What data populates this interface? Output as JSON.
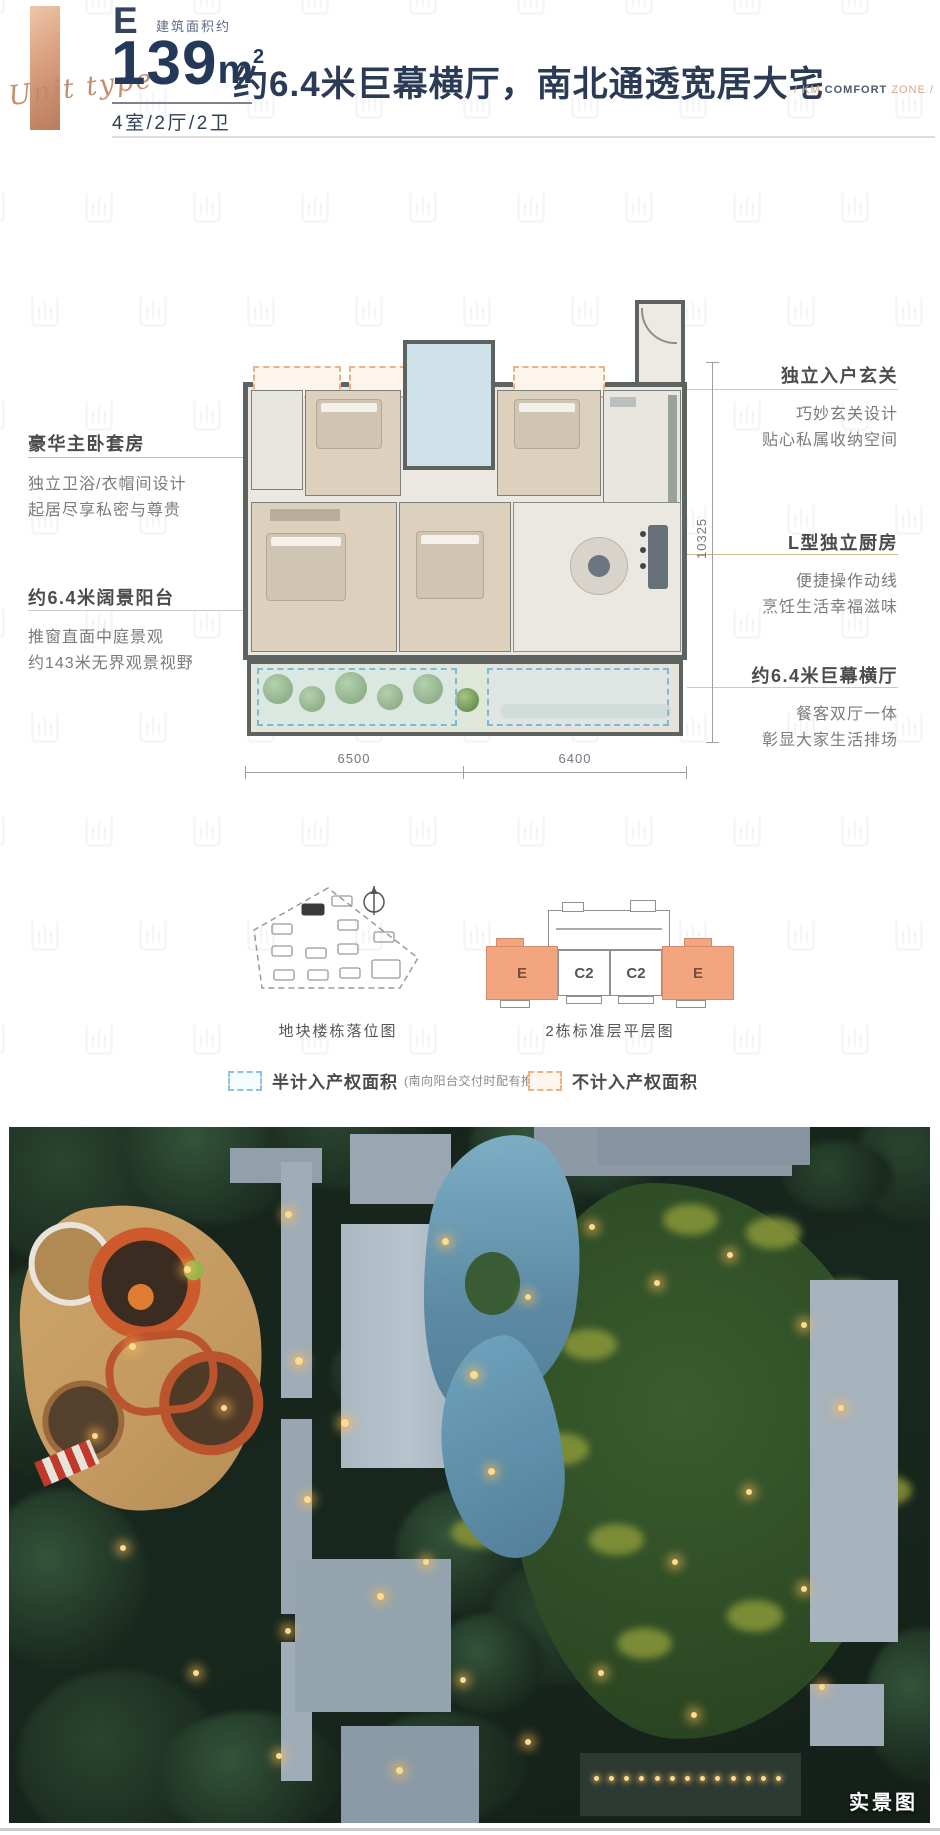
{
  "header": {
    "unit_letter": "E",
    "area_label": "建筑面积约",
    "area_number": "139",
    "area_unit": "m",
    "area_sup": "2",
    "unit_type_script": "Unit type",
    "rooms_spec": "4室/2厅/2卫",
    "main_title": "约6.4米巨幕横厅，南北通透宽居大宅",
    "tagline": {
      "left": "/  KM ",
      "mid": "COMFORT",
      "right": " ZONE  /"
    }
  },
  "floorplan": {
    "dim_width_left": "6500",
    "dim_width_right": "6400",
    "dim_height": "10325",
    "annotations_left": [
      {
        "title": "豪华主卧套房",
        "line1": "独立卫浴/衣帽间设计",
        "line2": "起居尽享私密与尊贵"
      },
      {
        "title": "约6.4米阔景阳台",
        "line1": "推窗直面中庭景观",
        "line2": "约143米无界观景视野"
      }
    ],
    "annotations_right": [
      {
        "title": "独立入户玄关",
        "line1": "巧妙玄关设计",
        "line2": "贴心私属收纳空间"
      },
      {
        "title": "L型独立厨房",
        "line1": "便捷操作动线",
        "line2": "烹饪生活幸福滋味"
      },
      {
        "title": "约6.4米巨幕横厅",
        "line1": "餐客双厅一体",
        "line2": "彰显大家生活排场"
      }
    ]
  },
  "site_plans": {
    "plot_caption": "地块楼栋落位图",
    "floor_caption": "2栋标准层平层图",
    "units": [
      {
        "label": "E"
      },
      {
        "label": "C2"
      },
      {
        "label": "C2"
      },
      {
        "label": "E"
      }
    ],
    "legend": [
      {
        "label": "半计入产权面积",
        "note": "(南向阳台交付时配有推拉门)",
        "color": "#8fc3dc"
      },
      {
        "label": "不计入产权面积",
        "note": "",
        "color": "#eab489"
      }
    ]
  },
  "photo": {
    "caption": "实景图"
  },
  "colors": {
    "navy": "#2b3a55",
    "copper": "#d8a488",
    "copper_bar": "#d99f7e",
    "salmon_unit": "#f2a57f",
    "legend_blue": "#8fc3dc",
    "legend_orange": "#eab489",
    "annotation_title": "#4b4b4b",
    "annotation_body": "#7b7b7b"
  }
}
